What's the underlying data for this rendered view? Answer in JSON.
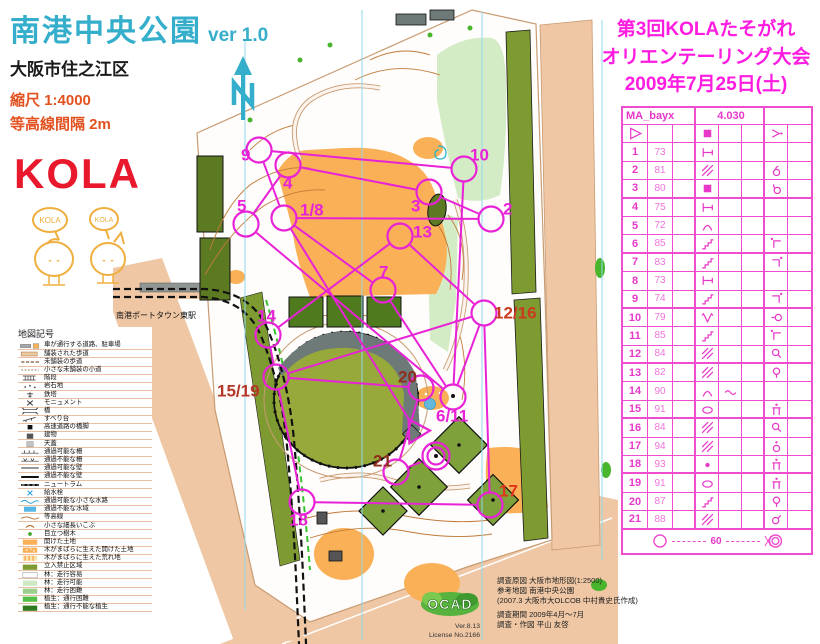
{
  "colors": {
    "magenta_course": "#E822D6",
    "card_grid": "#F04CCF",
    "title_teal": "#35AECB",
    "scale_red": "#E2511F",
    "kola_red": "#E8192C",
    "event_magenta": "#FF1CE0"
  },
  "header": {
    "title": "南港中央公園",
    "version": "ver 1.0",
    "subtitle": "大阪市住之江区",
    "scale": "縮尺  1:4000",
    "contour": "等高線間隔  2m"
  },
  "logo": {
    "text": "KOLA",
    "bubble1": "KOLA",
    "bubble2": "KOLA"
  },
  "event": {
    "line1": "第3回KOLAたそがれ",
    "line2": "オリエンテーリング大会",
    "line3": "2009年7月25日(土)"
  },
  "legend": {
    "title": "地図記号",
    "items": [
      {
        "sym": "road",
        "label": "車が通行する道路、駐車場"
      },
      {
        "sym": "paved",
        "label": "舗装された歩道"
      },
      {
        "sym": "unpaved",
        "label": "未舗装の歩道"
      },
      {
        "sym": "small-path",
        "label": "小さな未舗装の小道"
      },
      {
        "sym": "steps",
        "label": "階段"
      },
      {
        "sym": "rocky",
        "label": "岩石地"
      },
      {
        "sym": "pylon",
        "label": "鉄塔"
      },
      {
        "sym": "monument",
        "label": "モニュメント"
      },
      {
        "sym": "bridge",
        "label": "橋"
      },
      {
        "sym": "slide",
        "label": "すべり台"
      },
      {
        "sym": "pier",
        "label": "高速道路の橋脚"
      },
      {
        "sym": "building",
        "label": "建物"
      },
      {
        "sym": "canopy",
        "label": "天蓋"
      },
      {
        "sym": "passable-fence",
        "label": "通過可能な柵"
      },
      {
        "sym": "impassable-fence",
        "label": "通過不能な柵"
      },
      {
        "sym": "passable-wall",
        "label": "通過可能な壁"
      },
      {
        "sym": "impassable-wall",
        "label": "通過不能な壁"
      },
      {
        "sym": "tram",
        "label": "ニュートラム"
      },
      {
        "sym": "hydrant",
        "label": "給水栓"
      },
      {
        "sym": "small-watercourse",
        "label": "通過可能な小さな水路"
      },
      {
        "sym": "water",
        "label": "通過不能な水域"
      },
      {
        "sym": "contour",
        "label": "等高線"
      },
      {
        "sym": "small-knoll",
        "label": "小さな細長いこぶ"
      },
      {
        "sym": "tree",
        "label": "目立つ樹木"
      },
      {
        "sym": "open-land",
        "label": "開けた土地"
      },
      {
        "sym": "open-scattered",
        "label": "木がまばらに生えた開けた土地"
      },
      {
        "sym": "rough-scattered",
        "label": "木がまばらに生えた荒れ地"
      },
      {
        "sym": "forbidden",
        "label": "立入禁止区域"
      },
      {
        "sym": "forest-easy",
        "label": "林：走行容易"
      },
      {
        "sym": "forest-ok",
        "label": "林：走行可能"
      },
      {
        "sym": "forest-hard",
        "label": "林：走行困難"
      },
      {
        "sym": "veg-hard",
        "label": "植生：通行困難"
      },
      {
        "sym": "veg-impassable",
        "label": "植生：通行不能な植生"
      }
    ]
  },
  "map": {
    "station": "南港ポートタウン東駅",
    "course": {
      "color": "#E822D6",
      "start": {
        "x": 416,
        "y": 431
      },
      "finish": {
        "x": 436,
        "y": 456
      },
      "controls": [
        {
          "label": "1/8",
          "x": 284,
          "y": 218,
          "lx": 300,
          "ly": 211
        },
        {
          "label": "2",
          "x": 491,
          "y": 219,
          "lx": 503,
          "ly": 210
        },
        {
          "label": "3",
          "x": 429,
          "y": 192,
          "lx": 411,
          "ly": 207
        },
        {
          "label": "4",
          "x": 288,
          "y": 165,
          "lx": 283,
          "ly": 184
        },
        {
          "label": "5",
          "x": 246,
          "y": 224,
          "lx": 237,
          "ly": 207
        },
        {
          "label": "6/11",
          "x": 453,
          "y": 397,
          "lx": 436,
          "ly": 417
        },
        {
          "label": "7",
          "x": 383,
          "y": 290,
          "lx": 379,
          "ly": 273
        },
        {
          "label": "9",
          "x": 259,
          "y": 150,
          "lx": 241,
          "ly": 156
        },
        {
          "label": "10",
          "x": 464,
          "y": 169,
          "lx": 470,
          "ly": 156
        },
        {
          "label": "12/16",
          "x": 484,
          "y": 313,
          "lx": 494,
          "ly": 314,
          "color": "#C93A20"
        },
        {
          "label": "13",
          "x": 400,
          "y": 236,
          "lx": 413,
          "ly": 233
        },
        {
          "label": "14",
          "x": 268,
          "y": 335,
          "lx": 257,
          "ly": 317
        },
        {
          "label": "15/19",
          "x": 276,
          "y": 377,
          "lx": 217,
          "ly": 392,
          "color": "#B5372A"
        },
        {
          "label": "17",
          "x": 490,
          "y": 505,
          "lx": 499,
          "ly": 492,
          "color": "#E0341C"
        },
        {
          "label": "18",
          "x": 302,
          "y": 502,
          "lx": 289,
          "ly": 521
        },
        {
          "label": "20",
          "x": 421,
          "y": 388,
          "lx": 398,
          "ly": 378,
          "color": "#8E2F1E"
        },
        {
          "label": "21",
          "x": 396,
          "y": 472,
          "lx": 373,
          "ly": 462,
          "color": "#8E2F1E"
        }
      ],
      "sequence": [
        "start",
        "1/8",
        "2",
        "3",
        "4",
        "5",
        "6/11",
        "7",
        "1/8",
        "9",
        "10",
        "6/11",
        "12/16",
        "13",
        "14",
        "15/19",
        "12/16",
        "17",
        "18",
        "15/19",
        "20",
        "21",
        "finish"
      ]
    }
  },
  "control_card": {
    "class_name": "MA_bayx",
    "length": "4.030",
    "start_row": {
      "a": "start",
      "d": "square-fill",
      "g": "bend-dot"
    },
    "rows": [
      {
        "no": "1",
        "code": "73",
        "d": "tee"
      },
      {
        "no": "2",
        "code": "81",
        "d": "hatch",
        "g": "ring-hook-top"
      },
      {
        "no": "3",
        "code": "80",
        "d": "square-fill",
        "g": "ring-hook-left"
      },
      {
        "no": "4",
        "code": "75",
        "d": "tee"
      },
      {
        "no": "5",
        "code": "72",
        "d": "arc"
      },
      {
        "no": "6",
        "code": "85",
        "d": "stairs",
        "g": "corner-dot-nw"
      },
      {
        "no": "7",
        "code": "83",
        "d": "stairs",
        "g": "corner-dot-ne"
      },
      {
        "no": "8",
        "code": "73",
        "d": "tee"
      },
      {
        "no": "9",
        "code": "74",
        "d": "stairs",
        "g": "corner-dot-ne"
      },
      {
        "no": "10",
        "code": "79",
        "d": "vee",
        "g": "ring-tail-w"
      },
      {
        "no": "11",
        "code": "85",
        "d": "stairs",
        "g": "corner-dot-nw"
      },
      {
        "no": "12",
        "code": "84",
        "d": "hatch",
        "g": "ring-tail-se"
      },
      {
        "no": "13",
        "code": "82",
        "d": "hatch",
        "g": "ring-tail-s"
      },
      {
        "no": "14",
        "code": "90",
        "d": "arc",
        "e": "wave"
      },
      {
        "no": "15",
        "code": "91",
        "d": "ellipse",
        "g": "pi-dot"
      },
      {
        "no": "16",
        "code": "84",
        "d": "hatch",
        "g": "ring-tail-se"
      },
      {
        "no": "17",
        "code": "94",
        "d": "hatch",
        "g": "ring-dot-top"
      },
      {
        "no": "18",
        "code": "93",
        "d": "dot",
        "g": "pi-dot"
      },
      {
        "no": "19",
        "code": "91",
        "d": "ellipse",
        "g": "pi-dot"
      },
      {
        "no": "20",
        "code": "87",
        "d": "stairs",
        "g": "ring-tail-s"
      },
      {
        "no": "21",
        "code": "88",
        "d": "hatch",
        "g": "ring-tail-ne"
      }
    ],
    "finish_distance": "60"
  },
  "credits": {
    "line1": "調査原図  大阪市地形図(1:2500)",
    "line2": "参考地図  南港中央公園",
    "line3": "(2007.3 大阪市大OLCOB 中村貴史氏作成)",
    "line4": "調査期間   2009年4月～7月",
    "line5": "調査・作図  平山 友啓",
    "ocad": "OCAD",
    "ver": "Ver.8.13",
    "license": "License No.2166"
  }
}
